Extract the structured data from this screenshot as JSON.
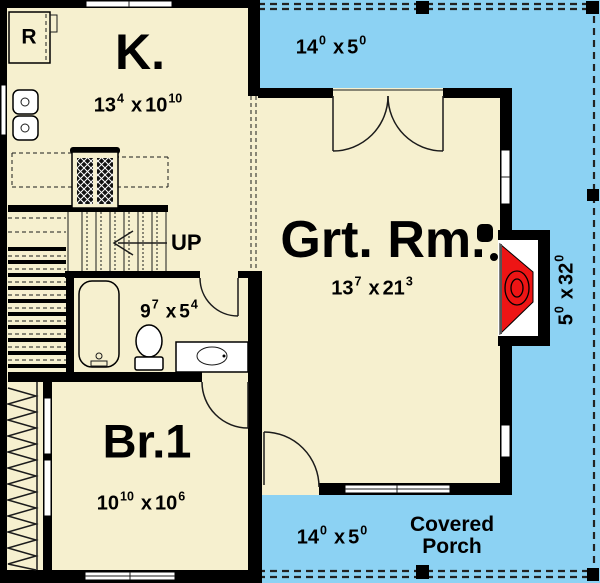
{
  "colors": {
    "floor": "#f6f0cf",
    "porch": "#8cd2f3",
    "wall": "#000000",
    "fireplace": "#ed1515"
  },
  "rooms": {
    "kitchen": {
      "label": "K.",
      "dims": {
        "w": "13",
        "wi": "4",
        "sep": "x",
        "h": "10",
        "hi": "10"
      }
    },
    "great_room": {
      "label": "Grt. Rm.",
      "dims": {
        "w": "13",
        "wi": "7",
        "sep": "x",
        "h": "21",
        "hi": "3"
      }
    },
    "bedroom1": {
      "label": "Br.1",
      "dims": {
        "w": "10",
        "wi": "10",
        "sep": "x",
        "h": "10",
        "hi": "6"
      }
    },
    "bathroom": {
      "dims": {
        "w": "9",
        "wi": "7",
        "sep": "x",
        "h": "5",
        "hi": "4"
      }
    },
    "stairs": {
      "label": "UP"
    },
    "refrigerator": {
      "label": "R"
    }
  },
  "porches": {
    "top": {
      "dims": {
        "w": "14",
        "wi": "0",
        "sep": "x",
        "h": "5",
        "hi": "0"
      }
    },
    "bottom": {
      "dims": {
        "w": "14",
        "wi": "0",
        "sep": "x",
        "h": "5",
        "hi": "0"
      },
      "label_line1": "Covered",
      "label_line2": "Porch"
    },
    "side": {
      "dims": {
        "w": "5",
        "wi": "0",
        "sep": "x",
        "h": "32",
        "hi": "0"
      }
    }
  }
}
